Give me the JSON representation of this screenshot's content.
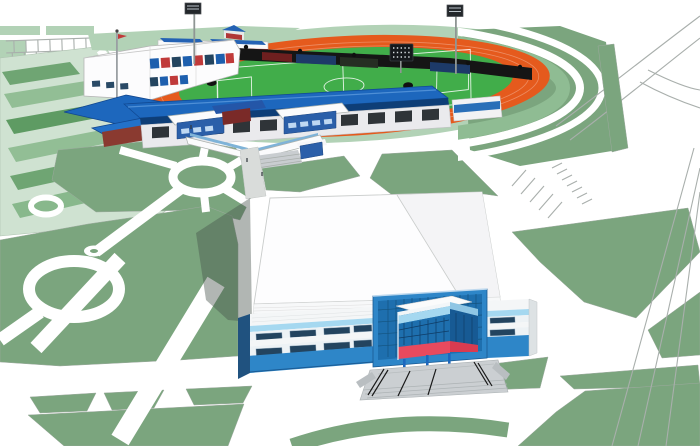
{
  "scene": {
    "description": "3D architectural rendering of a sports complex master plan: a stadium with an orange athletics track, green football pitch and blue-roofed grandstand at the rear; terraced lawn seating on the east curve; a large indoor sports hall with a triangular glass entrance in the foreground; outdoor courts, parking lots, roads and landscaped park lawns crossed by white pedestrian paths.",
    "objects": [
      {
        "id": "stadium",
        "label": "Stadium with athletics track and football pitch"
      },
      {
        "id": "grandstand",
        "label": "Main grandstand with blue roof"
      },
      {
        "id": "main-building",
        "label": "Stadium administration building"
      },
      {
        "id": "terraces",
        "label": "Terraced lawn seating at east curve"
      },
      {
        "id": "sports-hall",
        "label": "Indoor sports hall with triangular glass entrance"
      },
      {
        "id": "entrance-stairs",
        "label": "Entrance platform with stairs and railings"
      },
      {
        "id": "courts",
        "label": "Outdoor sports courts"
      },
      {
        "id": "parking",
        "label": "Parking areas"
      },
      {
        "id": "park",
        "label": "Park lawns and pedestrian paths"
      },
      {
        "id": "floodlights",
        "label": "Floodlight masts",
        "count": 2
      },
      {
        "id": "scoreboard",
        "label": "Stadium scoreboard"
      }
    ]
  },
  "colors": {
    "park_green": "#7BA57E",
    "park_green_light": "#92BE95",
    "court_green_dark": "#5E9B63",
    "pale_green": "#B2D2B6",
    "courts_base": "#CFE2D1",
    "pitch_green": "#41AD4A",
    "track_orange": "#E55A1D",
    "roof_blue": "#1D67BD",
    "stand_shadow_blue": "#0E3E77",
    "facade_blue": "#2E86C8",
    "glass_blue": "#1E6FAE",
    "glass_grid": "#14537F",
    "light_blue": "#A5D8F0",
    "red_accent": "#E84A5E",
    "dark_red": "#C03A3A",
    "window_dark": "#23445F",
    "road_line": "#A9AFAC",
    "platform_gray": "#CBCFD2",
    "pole_gray": "#8F9694",
    "structure_gray": "#EAEAED",
    "ad_board_dark": "#151515",
    "shadow": "#46504A"
  }
}
